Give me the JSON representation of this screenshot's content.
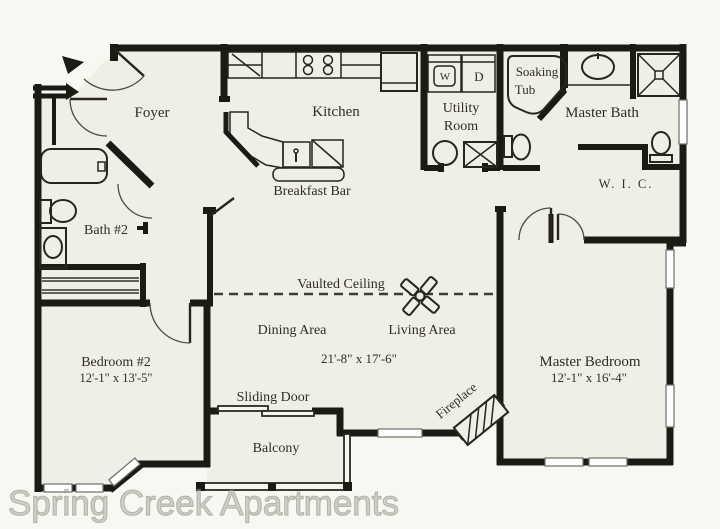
{
  "watermark": "Spring Creek Apartments",
  "colors": {
    "background": "#f8f7f2",
    "floor": "#f0efe7",
    "wall": "#1b1b15",
    "text": "#2e2e25",
    "watermark": "#b9b9b1"
  },
  "labels": {
    "foyer": "Foyer",
    "kitchen": "Kitchen",
    "utility_line1": "Utility",
    "utility_line2": "Room",
    "washer": "W",
    "dryer": "D",
    "soaking_line1": "Soaking",
    "soaking_line2": "Tub",
    "master_bath": "Master Bath",
    "wic": "W. I. C.",
    "bath2": "Bath #2",
    "breakfast_bar": "Breakfast Bar",
    "vaulted_ceiling": "Vaulted Ceiling",
    "dining_area": "Dining Area",
    "living_area": "Living Area",
    "living_dims": "21'-8\" x 17'-6\"",
    "sliding_door": "Sliding Door",
    "balcony": "Balcony",
    "fireplace": "Fireplace",
    "bedroom2": "Bedroom #2",
    "bedroom2_dims": "12'-1\" x 13'-5\"",
    "master_bedroom": "Master Bedroom",
    "master_bedroom_dims": "12'-1\" x 16'-4\""
  }
}
